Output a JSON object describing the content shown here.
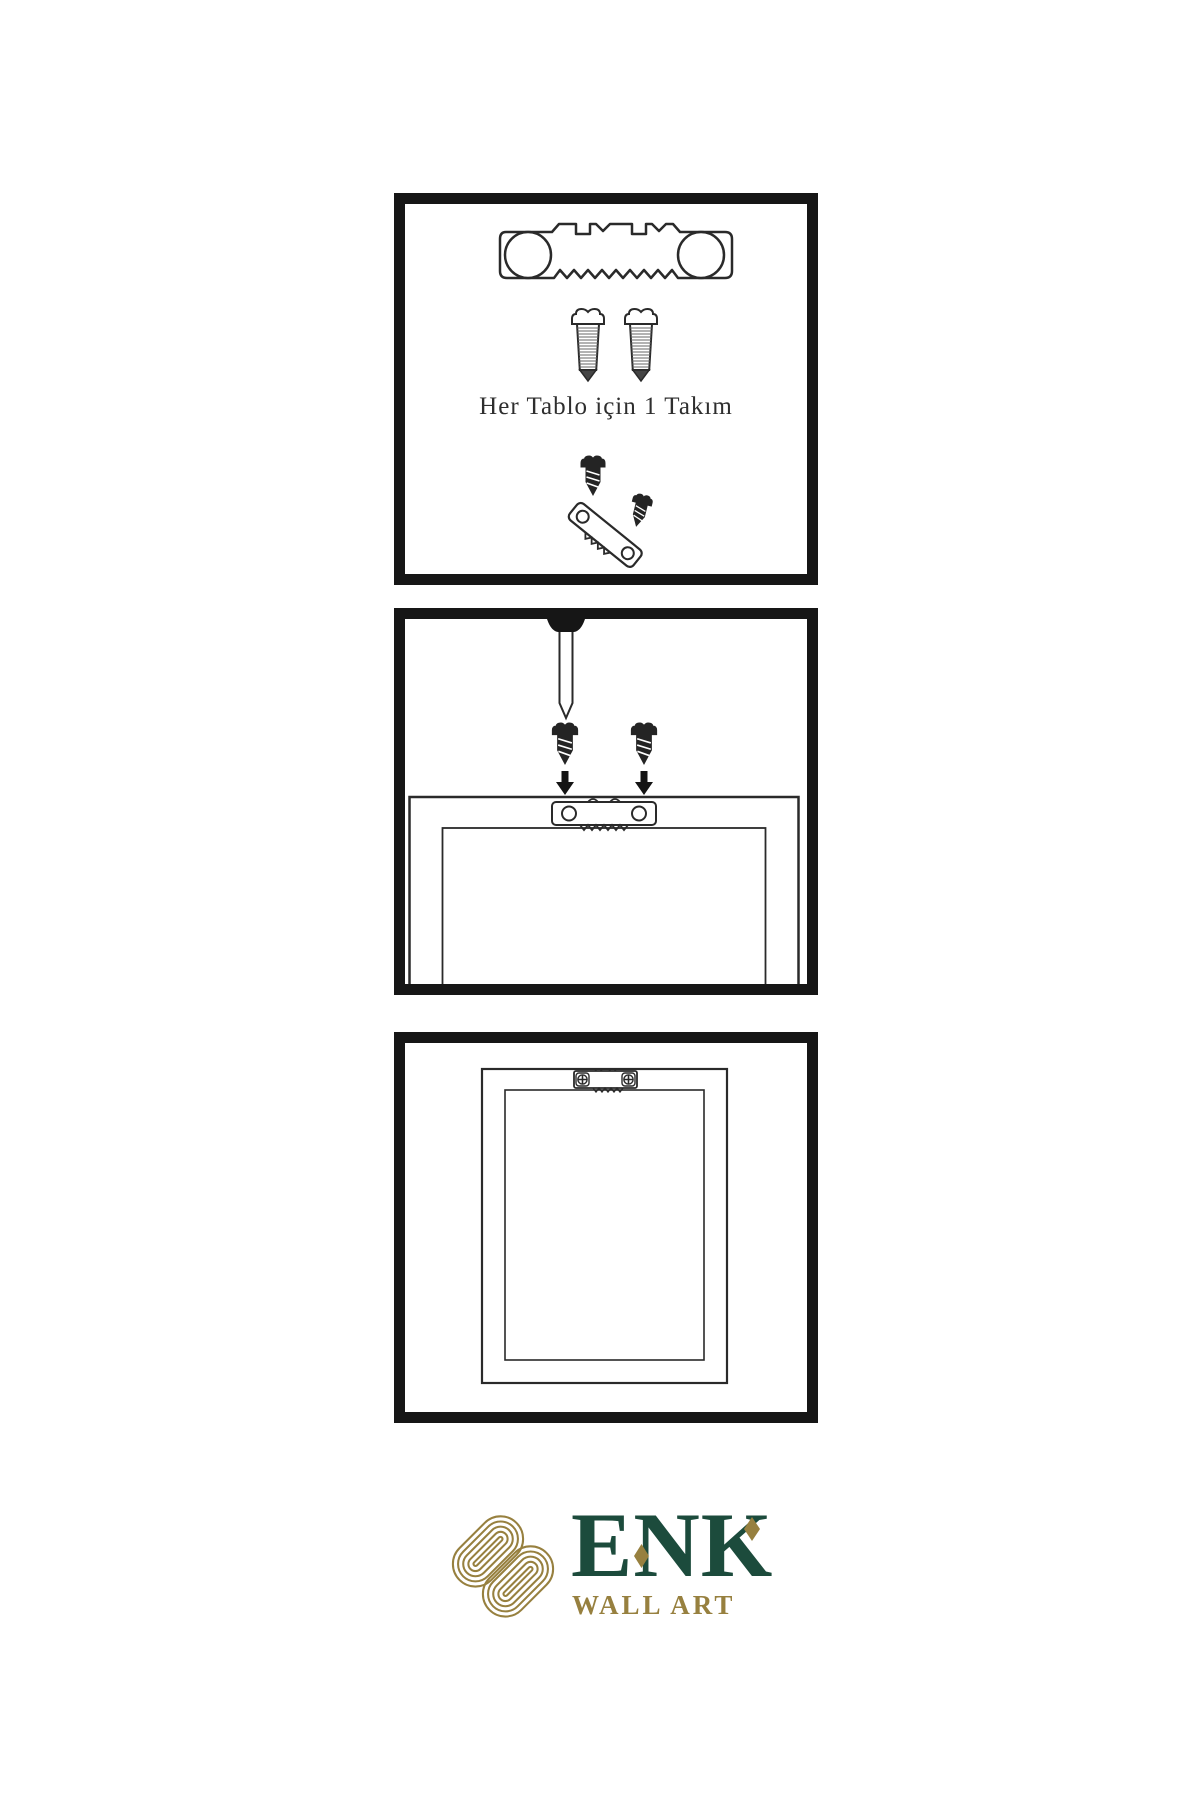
{
  "panels": [
    {
      "name": "hardware-kit",
      "caption": "Her Tablo için 1 Takım",
      "icons": [
        "sawtooth-hanger",
        "mounting-screw",
        "mounting-screw",
        "screw-into-hanger"
      ]
    },
    {
      "name": "wall-installation",
      "icons": [
        "wall-nail",
        "screw-with-arrow",
        "screw-with-arrow",
        "frame-back-with-sawtooth-hanger"
      ]
    },
    {
      "name": "mounted-frame",
      "icons": [
        "frame-back-with-screwed-hanger"
      ]
    }
  ],
  "brand": {
    "name": "ENK",
    "tagline": "WALL ART"
  },
  "colors": {
    "brand_green": "#1C4B3C",
    "brand_gold": "#97803F",
    "ink": "#1B1B1B",
    "line": "#2A2A2A",
    "background": "#FFFFFF"
  }
}
